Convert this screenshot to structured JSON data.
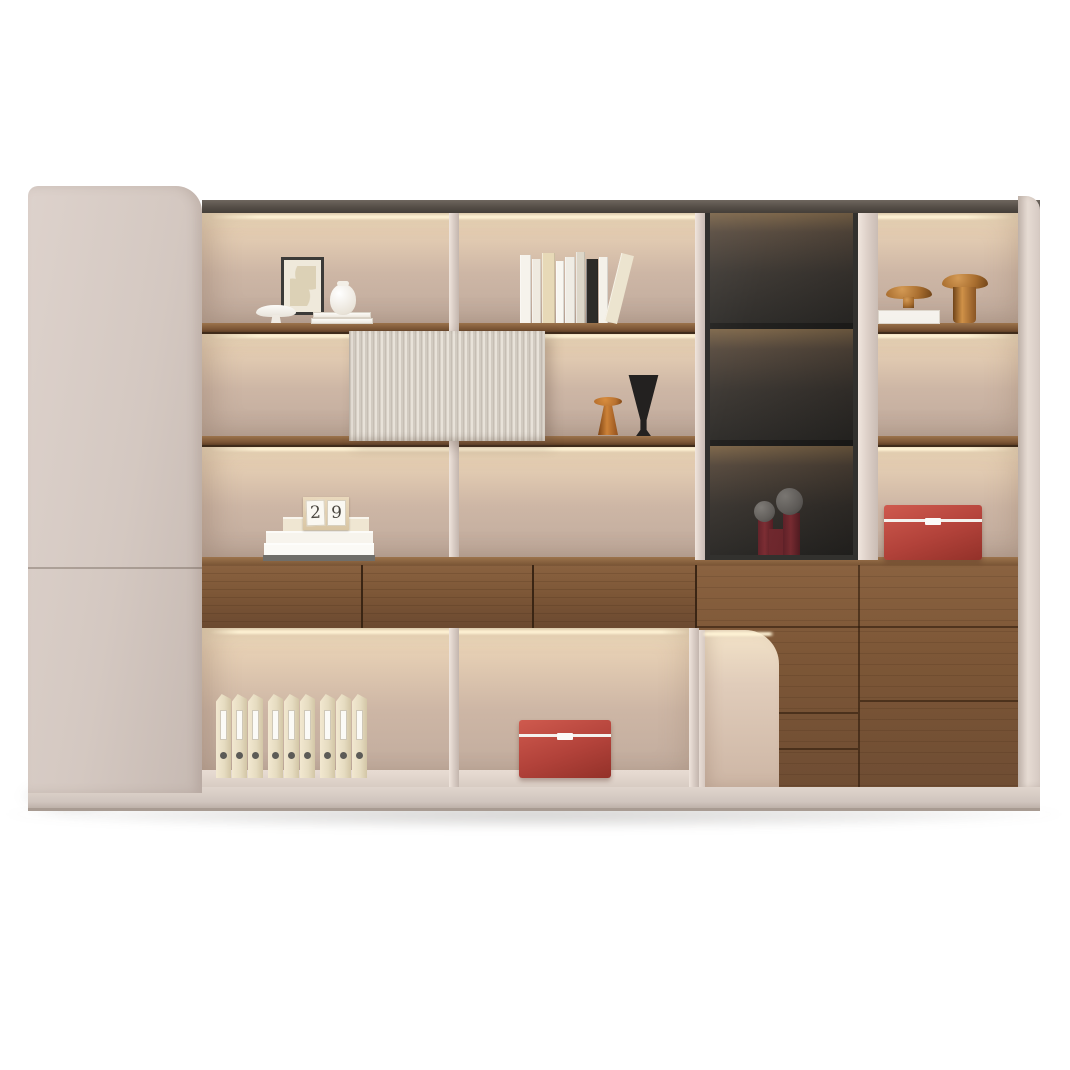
{
  "scene": {
    "type": "furniture-product-photo",
    "subject": "Modern cream and walnut bookshelf wall unit with integrated LED shelf lighting, smoked-glass display cabinet, fluted sliding door, walnut drawers, arched niche and open shelves",
    "background_color": "#ffffff"
  },
  "palette": {
    "bg": "#ffffff",
    "body_cream": "#d4c8c1",
    "body_cream_light": "#e0d5cd",
    "plinth": "#d0c5be",
    "top_trim_dark": "#554e47",
    "back_glow": "#f6e4c4",
    "back_mid": "#cdb6a5",
    "back_deep": "#c0ab9d",
    "wood_light": "#9c744c",
    "wood_mid": "#7d5737",
    "wood_dark": "#4a3322",
    "shelf_edge": "#3f2b1a",
    "flute_light": "#e8e2d9",
    "flute_dark": "#c6beb4",
    "glass_frame": "#32312e",
    "glass_dark": "#2c2a27",
    "glass_glow": "#7c6548",
    "bronze": "#a96e2f",
    "bronze_deep": "#6f4318",
    "red_box": "#b2423a",
    "red_box_light": "#cf5a4e",
    "maroon": "#8c3138",
    "sphere_grey": "#6e6a66",
    "binder": "#e6dcc1",
    "binder_label": "#fbfaf6",
    "black_decor": "#232120",
    "orange_decor": "#b8712f"
  },
  "calendar_block": {
    "digits": [
      "2",
      "9"
    ]
  },
  "row1_left": {
    "items": [
      "framed-abstract-art",
      "white-footed-bowl",
      "white-round-vase",
      "stacked-white-books"
    ]
  },
  "row1_mid_books": {
    "spines": [
      {
        "w": 11,
        "h": 68,
        "c": "#f6f3ec"
      },
      {
        "w": 9,
        "h": 64,
        "c": "#efeae0"
      },
      {
        "w": 13,
        "h": 70,
        "c": "#e7d9b7"
      },
      {
        "w": 8,
        "h": 62,
        "c": "#f8f6f0"
      },
      {
        "w": 10,
        "h": 66,
        "c": "#efece4"
      },
      {
        "w": 9,
        "h": 71,
        "c": "#dcd6c8"
      },
      {
        "w": 12,
        "h": 64,
        "c": "#2e2c29"
      },
      {
        "w": 9,
        "h": 66,
        "c": "#f4f1e9"
      }
    ],
    "leaning": {
      "w": 13,
      "h": 70,
      "c": "#ece4cf"
    }
  },
  "row1_right": {
    "items": [
      "acrylic-display-box",
      "bronze-pedestal-bowl-small",
      "bronze-pedestal-bowl-large"
    ]
  },
  "row2": {
    "items": [
      "fluted-sliding-door",
      "orange-pedestal-cup",
      "black-cone-vase"
    ]
  },
  "row3_left": {
    "items": [
      "wood-calendar-block",
      "stacked-books"
    ]
  },
  "row3_right": {
    "items": [
      "red-storage-box"
    ]
  },
  "glass_cabinet": {
    "compartments": 3,
    "items": [
      "maroon-candlestick-small",
      "maroon-candlestick-large",
      "maroon-vessel"
    ]
  },
  "drawers": {
    "count": 3
  },
  "bottom": {
    "binders_count": 9,
    "items": [
      "file-binders",
      "red-storage-box"
    ]
  }
}
